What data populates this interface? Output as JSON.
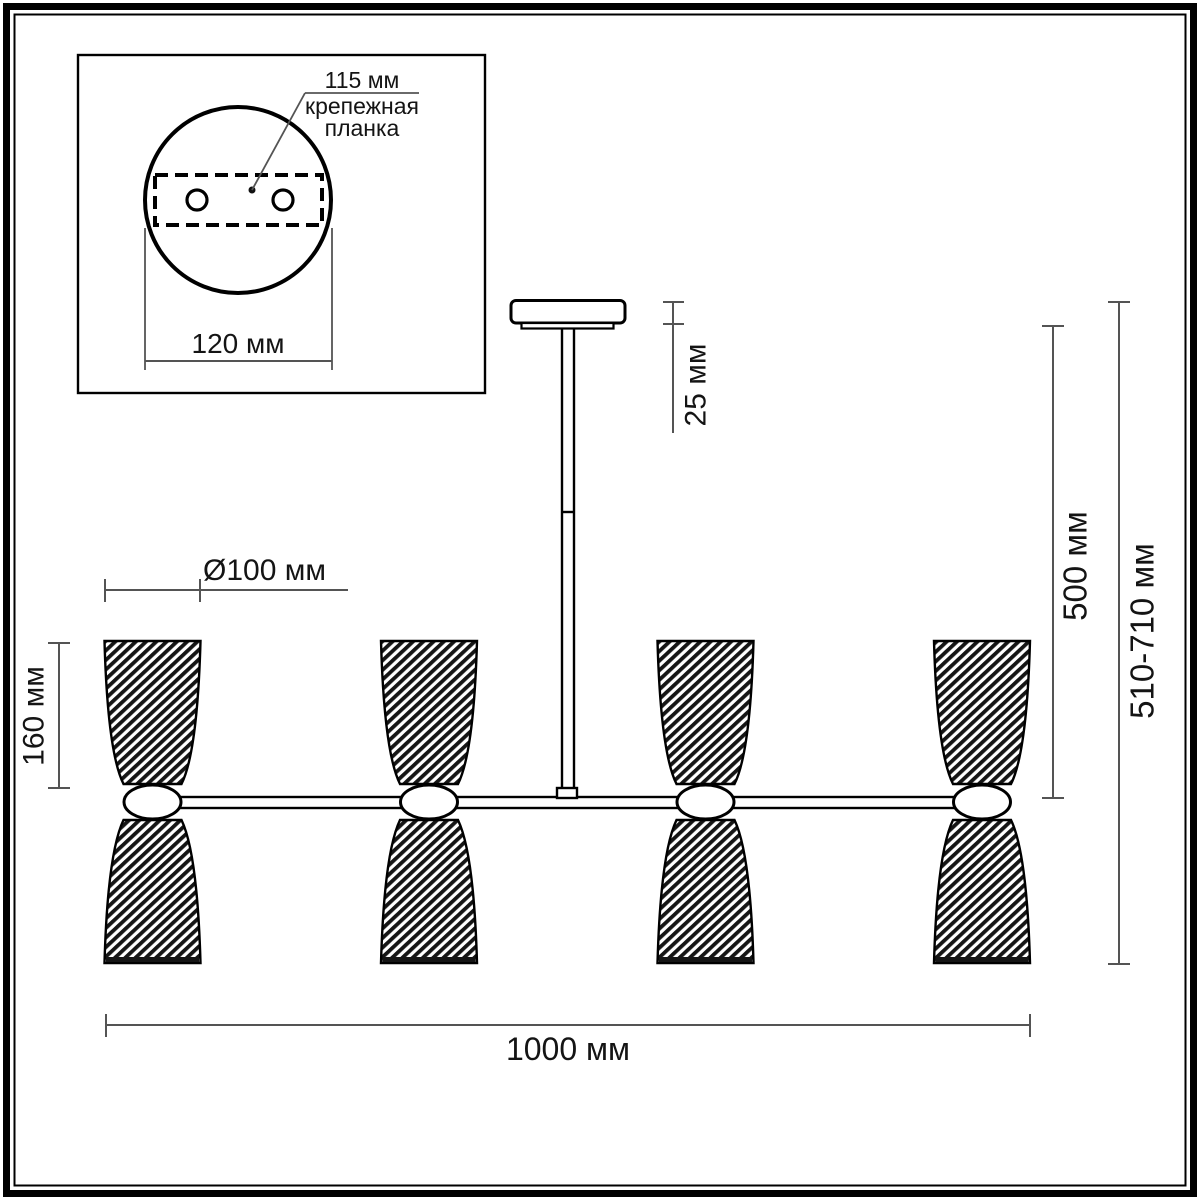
{
  "diagram": {
    "inset": {
      "hole_spacing_label": "115 мм",
      "mount_plate_label_line1": "крепежная",
      "mount_plate_label_line2": "планка",
      "canopy_diameter_label": "120 мм"
    },
    "main": {
      "canopy_height_label": "25 мм",
      "rod_length_label": "500 мм",
      "overall_height_label": "510-710 мм",
      "shade_diameter_label": "Ø100 мм",
      "shade_height_label": "160 мм",
      "overall_width_label": "1000 мм"
    },
    "colors": {
      "outline": "#000000",
      "dimension_line": "#545454",
      "label_text": "#141414",
      "background": "#ffffff"
    }
  }
}
